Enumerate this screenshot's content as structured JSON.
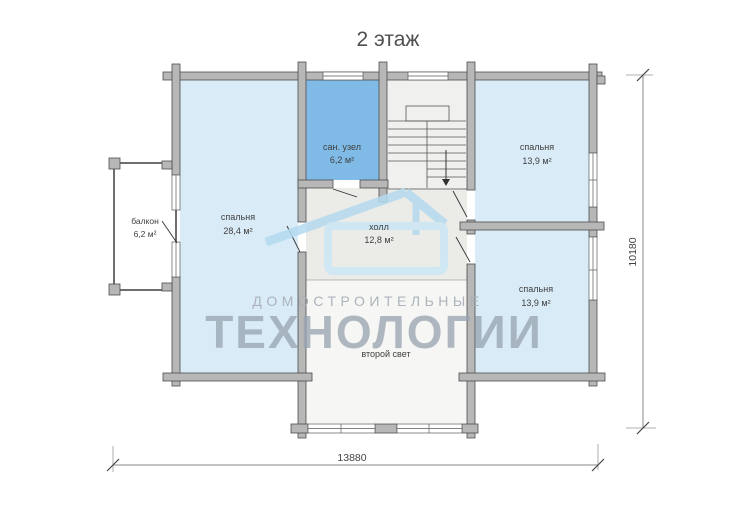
{
  "title": "2 этаж",
  "watermark": {
    "line1": "ДОМОСТРОИТЕЛЬНЫЕ",
    "line2": "ТЕХНОЛОГИИ"
  },
  "rooms": {
    "san_uzel": {
      "name": "сан. узел",
      "area": "6,2 м²"
    },
    "bedroom_left": {
      "name": "спальня",
      "area": "28,4 м²"
    },
    "bedroom_top_right": {
      "name": "спальня",
      "area": "13,9 м²"
    },
    "bedroom_bottom_right": {
      "name": "спальня",
      "area": "13,9 м²"
    },
    "hall": {
      "name": "холл",
      "area": "12,8 м²"
    },
    "balcony": {
      "name": "балкон",
      "area": "6,2 м²"
    },
    "second_light": {
      "name": "второй свет"
    }
  },
  "dimensions": {
    "width_mm": "13880",
    "height_mm": "10180"
  },
  "colors": {
    "bedroom_fill": "#d9ebf6",
    "san_uzel_fill": "#80bbe7",
    "hall_fill": "#ebebe8",
    "stairs_fill": "#f0f0ee",
    "second_light_fill": "#f6f6f4",
    "balcony_fill": "#ffffff",
    "wall_fill": "#b7b7b7",
    "watermark_blue": "#b4daf0",
    "watermark_gray": "#9da8b3"
  }
}
